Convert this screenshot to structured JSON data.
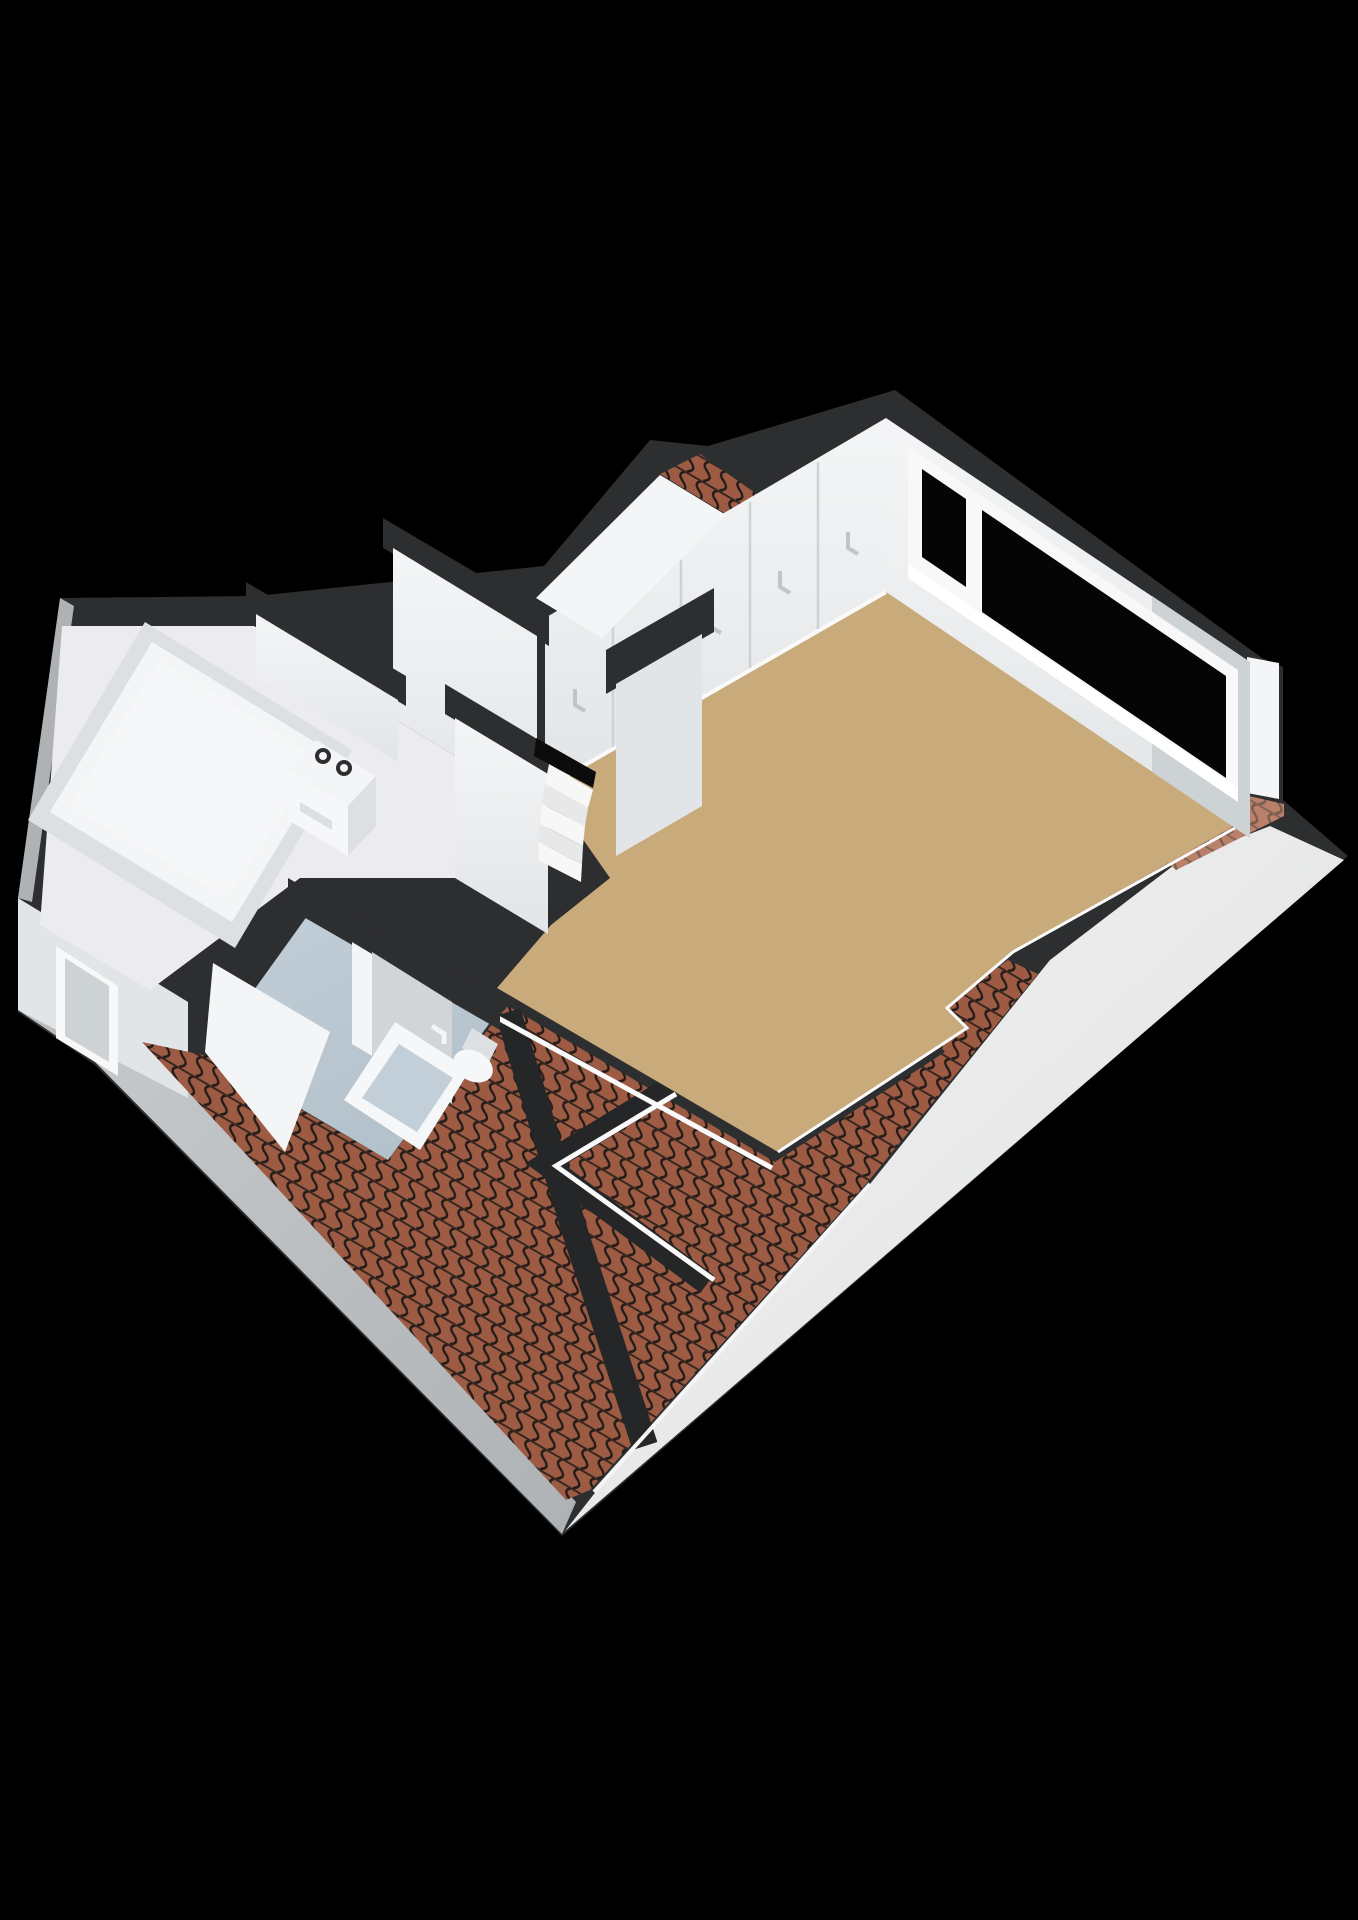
{
  "scene": {
    "title": "3D attic floor plan render",
    "view": "isometric-cutaway",
    "background": "#000000"
  },
  "colors": {
    "background": "#000000",
    "wall_top": "#2d2e30",
    "wall_top_dark": "#252628",
    "wall_face": "#f4f5f6",
    "wall_face_shade": "#e2e5e7",
    "wall_face_dark": "#cdd2d5",
    "slope_light": "#f5f5f5",
    "slope_mid": "#dcdddd",
    "gable_gray": "#c5c8ca",
    "gable_gray_dark": "#aeb2b4",
    "floor_main": "#c9aa7a",
    "floor_main_dark": "#bb9c6c",
    "floor_bath": "#b3c1cb",
    "floor_bath_light": "#c3cfd8",
    "floor_bedroom": "#ececee",
    "roof_tile": "#9d5b44",
    "roof_tile_line": "#241c18",
    "roof_tile_row": "#35261f",
    "tile_patch_light": "#e0ac97",
    "glass": "#050505",
    "window_frame": "#f8f8f8",
    "sill_white": "#ffffff",
    "fixture_white": "#f6f7f8",
    "fixture_shade": "#dde0e2",
    "door_gray": "#d2d5d7",
    "handle_gray": "#c2c4c6",
    "skirting": "#fafafa",
    "stair_light": "#f7f7f7",
    "stair_shade": "#e7e8e9",
    "opening_dark": "#0c0c0c"
  },
  "rooms": [
    {
      "name": "attic-room",
      "floor": "floor_main"
    },
    {
      "name": "landing-hall",
      "floor": "floor_main"
    },
    {
      "name": "bathroom",
      "floor": "floor_bath"
    },
    {
      "name": "bedroom",
      "floor": "floor_bedroom"
    },
    {
      "name": "stairwell",
      "floor": "opening_dark"
    }
  ],
  "fixtures": [
    {
      "name": "dormer-window",
      "panes": 2,
      "glass": "glass"
    },
    {
      "name": "side-window",
      "panes": 1
    },
    {
      "name": "wardrobe-closets",
      "doors": 5
    },
    {
      "name": "bed"
    },
    {
      "name": "washing-machine",
      "knobs": 2
    },
    {
      "name": "shower-tray"
    },
    {
      "name": "toilet"
    },
    {
      "name": "bathroom-door"
    },
    {
      "name": "winder-stairs",
      "steps": 5
    }
  ]
}
